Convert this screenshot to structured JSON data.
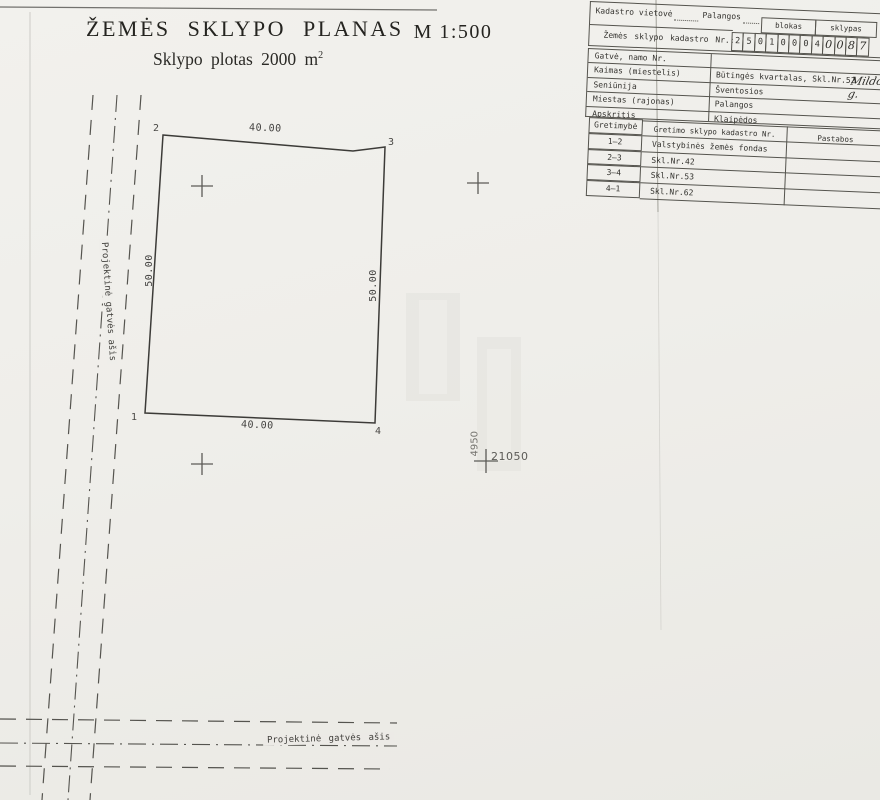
{
  "title": {
    "main": "ŽEMĖS SKLYPO PLANAS",
    "scale": "M 1:500",
    "area_text": "Sklypo plotas 2000 m",
    "area_sup": "2"
  },
  "plot": {
    "corner_1": "1",
    "corner_2": "2",
    "corner_3": "3",
    "corner_4": "4",
    "dim_top": "40.00",
    "dim_bottom": "40.00",
    "dim_left": "50.00",
    "dim_right": "50.00"
  },
  "grid": {
    "x_coord": "21050",
    "y_coord": "4950"
  },
  "street": {
    "vertical_axis_label": "Projektinė gatvės ašis",
    "horizontal_axis_label": "Projektinė gatvės ašis"
  },
  "cadastre": {
    "location_label": "Kadastro vietovė",
    "location_value": "Palangos",
    "number_label": "Žemės sklypo kadastro Nr.:",
    "blokas_label": "blokas",
    "sklypas_label": "sklypas",
    "digits_typed": [
      "2",
      "5",
      "0",
      "1",
      "0",
      "0",
      "0",
      "4"
    ],
    "digits_hand": [
      "0",
      "0",
      "8",
      "7"
    ]
  },
  "address": {
    "rows": [
      {
        "label": "Gatvė, namo Nr.",
        "value": ""
      },
      {
        "label": "Kaimas (miestelis)",
        "value": "Būtingės kvartalas, Skl.Nr.52",
        "hand": "Mildo g."
      },
      {
        "label": "Seniūnija",
        "value": "Šventosios"
      },
      {
        "label": "Miestas (rajonas)",
        "value": "Palangos"
      },
      {
        "label": "Apskritis",
        "value": "Klaipėdos"
      }
    ]
  },
  "adjacency": {
    "col_gretimybe": "Gretimybė",
    "col_kadastro": "Gretimo sklypo kadastro Nr.",
    "col_pastabos": "Pastabos",
    "rows": [
      {
        "range": "1–2",
        "value": "Valstybinės žemės fondas"
      },
      {
        "range": "2–3",
        "value": "Skl.Nr.42"
      },
      {
        "range": "3–4",
        "value": "Skl.Nr.53"
      },
      {
        "range": "4–1",
        "value": "Skl.Nr.62"
      }
    ]
  }
}
